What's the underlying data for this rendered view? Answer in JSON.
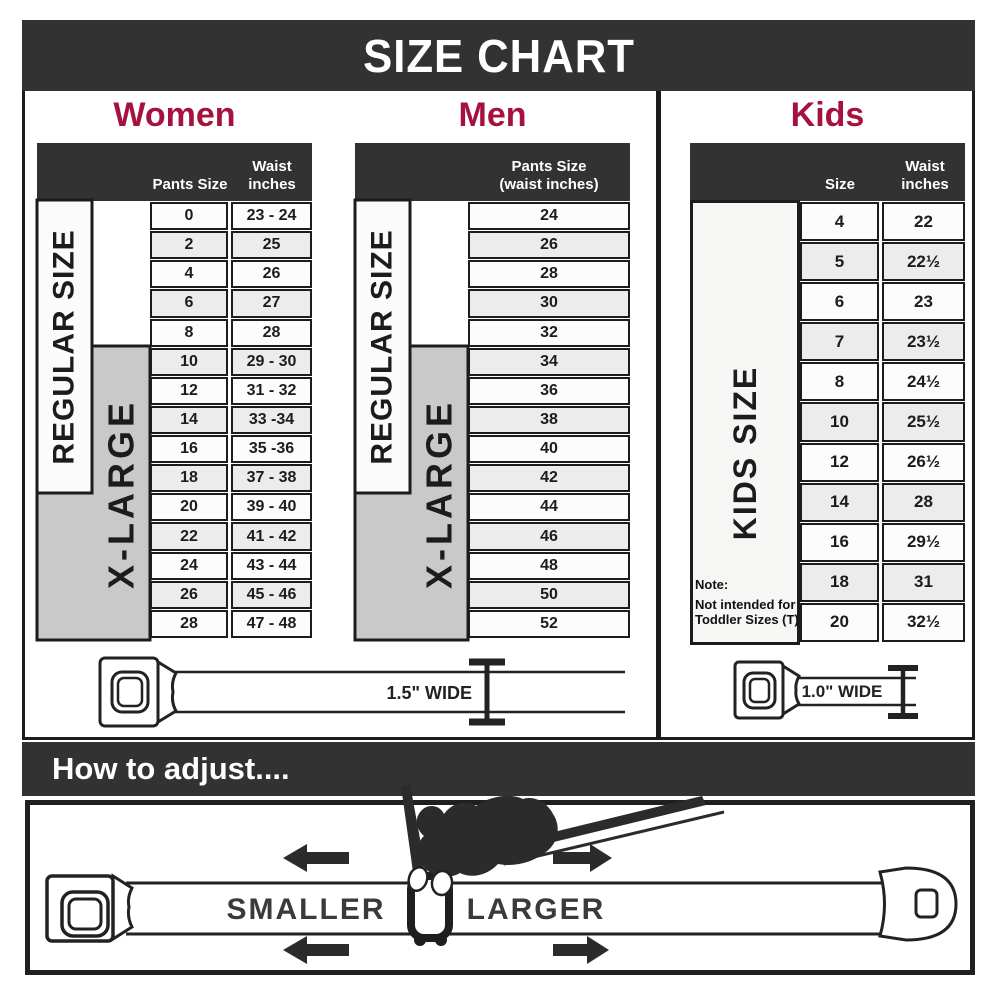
{
  "header": {
    "title": "SIZE CHART"
  },
  "colors": {
    "accent_red": "#A6123F",
    "bar_dark": "#323232",
    "row_stripe": "#ECECEC",
    "xlarge_gray": "#C9C9C9"
  },
  "women": {
    "title": "Women",
    "col1_header": "Pants Size",
    "col2_header_line1": "Waist",
    "col2_header_line2": "inches",
    "regular_label": "REGULAR SIZE",
    "xlarge_label": "X-LARGE",
    "rows": [
      {
        "size": "0",
        "waist": "23 - 24"
      },
      {
        "size": "2",
        "waist": "25"
      },
      {
        "size": "4",
        "waist": "26"
      },
      {
        "size": "6",
        "waist": "27"
      },
      {
        "size": "8",
        "waist": "28"
      },
      {
        "size": "10",
        "waist": "29 - 30"
      },
      {
        "size": "12",
        "waist": "31 - 32"
      },
      {
        "size": "14",
        "waist": "33 -34"
      },
      {
        "size": "16",
        "waist": "35 -36"
      },
      {
        "size": "18",
        "waist": "37 - 38"
      },
      {
        "size": "20",
        "waist": "39 - 40"
      },
      {
        "size": "22",
        "waist": "41 - 42"
      },
      {
        "size": "24",
        "waist": "43 - 44"
      },
      {
        "size": "26",
        "waist": "45 - 46"
      },
      {
        "size": "28",
        "waist": "47 - 48"
      }
    ]
  },
  "men": {
    "title": "Men",
    "col_header_line1": "Pants Size",
    "col_header_line2": "(waist inches)",
    "regular_label": "REGULAR SIZE",
    "xlarge_label": "X-LARGE",
    "rows": [
      {
        "value": "24"
      },
      {
        "value": "26"
      },
      {
        "value": "28"
      },
      {
        "value": "30"
      },
      {
        "value": "32"
      },
      {
        "value": "34"
      },
      {
        "value": "36"
      },
      {
        "value": "38"
      },
      {
        "value": "40"
      },
      {
        "value": "42"
      },
      {
        "value": "44"
      },
      {
        "value": "46"
      },
      {
        "value": "48"
      },
      {
        "value": "50"
      },
      {
        "value": "52"
      }
    ]
  },
  "kids": {
    "title": "Kids",
    "col1_header": "Size",
    "col2_header_line1": "Waist",
    "col2_header_line2": "inches",
    "size_label": "KIDS SIZE",
    "note_line1": "Note:",
    "note_line2": "Not intended for",
    "note_line3": "Toddler Sizes (T)",
    "rows": [
      {
        "size": "4",
        "waist": "22"
      },
      {
        "size": "5",
        "waist": "22½"
      },
      {
        "size": "6",
        "waist": "23"
      },
      {
        "size": "7",
        "waist": "23½"
      },
      {
        "size": "8",
        "waist": "24½"
      },
      {
        "size": "10",
        "waist": "25½"
      },
      {
        "size": "12",
        "waist": "26½"
      },
      {
        "size": "14",
        "waist": "28"
      },
      {
        "size": "16",
        "waist": "29½"
      },
      {
        "size": "18",
        "waist": "31"
      },
      {
        "size": "20",
        "waist": "32½"
      }
    ]
  },
  "belts": {
    "adult_width_label": "1.5\" WIDE",
    "kids_width_label": "1.0\" WIDE"
  },
  "adjust": {
    "bar_title": "How to adjust....",
    "smaller_label": "SMALLER",
    "larger_label": "LARGER"
  }
}
